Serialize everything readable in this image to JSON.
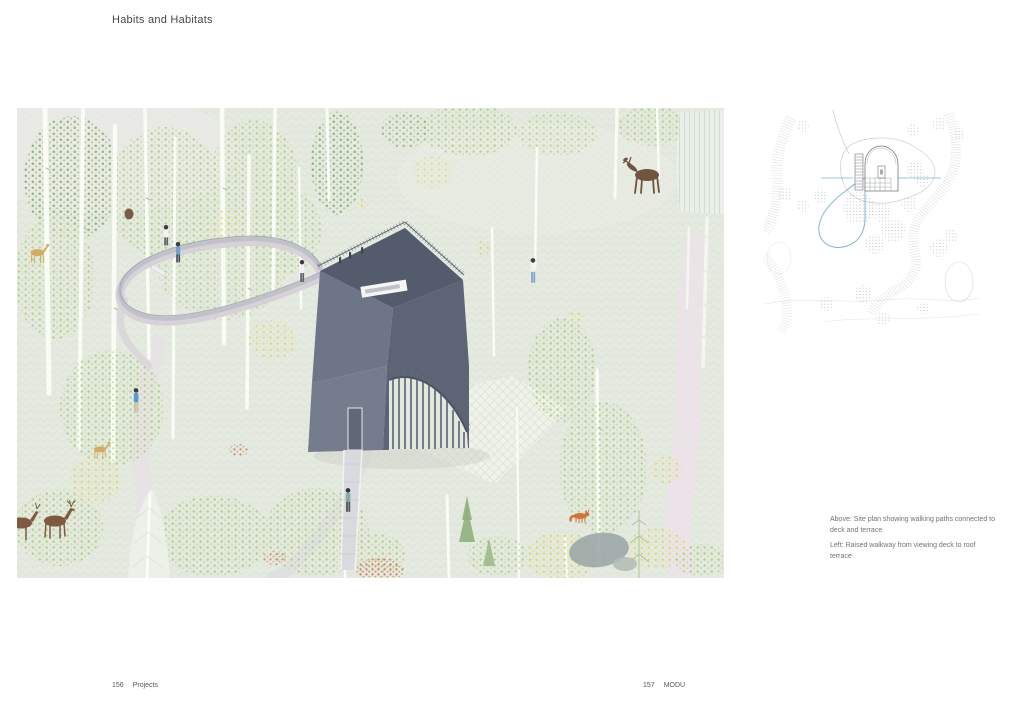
{
  "page": {
    "title": "Habits and Habitats"
  },
  "captions": {
    "above": "Above: Site plan showing walking paths connected to deck and terrace",
    "left": "Left: Raised walkway from viewing deck to roof terrace"
  },
  "footer": {
    "left": {
      "page_number": "156",
      "section": "Projects"
    },
    "right": {
      "page_number": "157",
      "section": "MODU"
    }
  },
  "colors": {
    "background": "#e5eae1",
    "tower_gray_blue": "#6d7487",
    "walkway_deck": "#d6d2d8",
    "site_plan_blue": "#7fb6c6",
    "foliage_green": "#b2cf86",
    "accent_red": "#cf6a4e",
    "accent_yellow": "#dfd973",
    "moose_brown": "#6f5440",
    "fox_orange": "#d2713e"
  }
}
